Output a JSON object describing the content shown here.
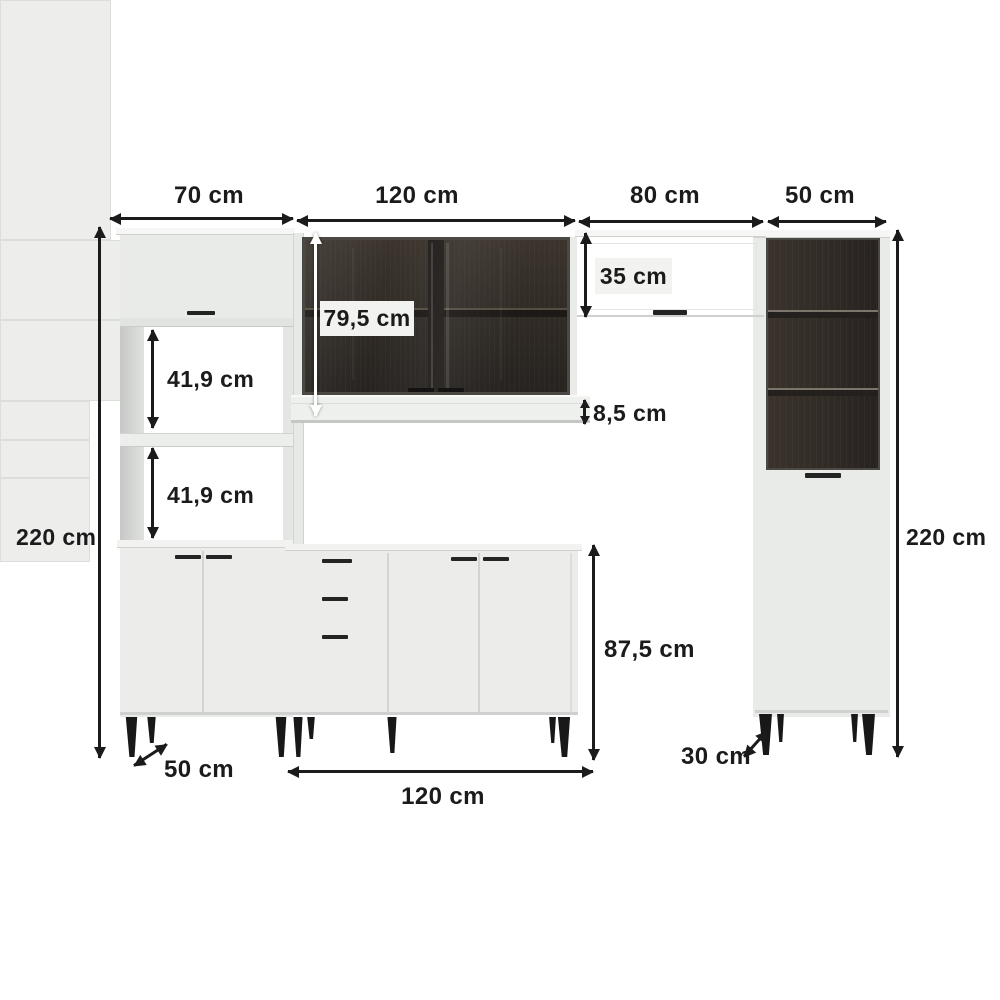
{
  "diagram": {
    "unit": "cm",
    "dims": {
      "top": [
        {
          "id": "hutch-width",
          "label": "70 cm"
        },
        {
          "id": "wall-cabinet-width",
          "label": "120 cm"
        },
        {
          "id": "overhead-cabinet-width",
          "label": "80 cm"
        },
        {
          "id": "tall-cabinet-width",
          "label": "50 cm"
        }
      ],
      "left_total_height": "220 cm",
      "right_total_height": "220 cm",
      "internal": {
        "wall_cabinet_height": "79,5 cm",
        "upper_niche_height": "41,9 cm",
        "lower_niche_height": "41,9 cm",
        "overhead_cabinet_height": "35 cm",
        "countertop_thickness": "8,5 cm",
        "base_cabinet_height": "87,5 cm"
      },
      "bottom": {
        "hutch_depth": "50 cm",
        "base_cabinet_width": "120 cm",
        "tall_cabinet_depth": "30 cm"
      }
    },
    "colors": {
      "background": "#ffffff",
      "dimension_ink": "#1b1b1b",
      "cabinet_white": "#ecedeb",
      "interior_dark": "#2f2a25",
      "label_chip": "#f2f2f0",
      "legs": "#181818"
    }
  }
}
